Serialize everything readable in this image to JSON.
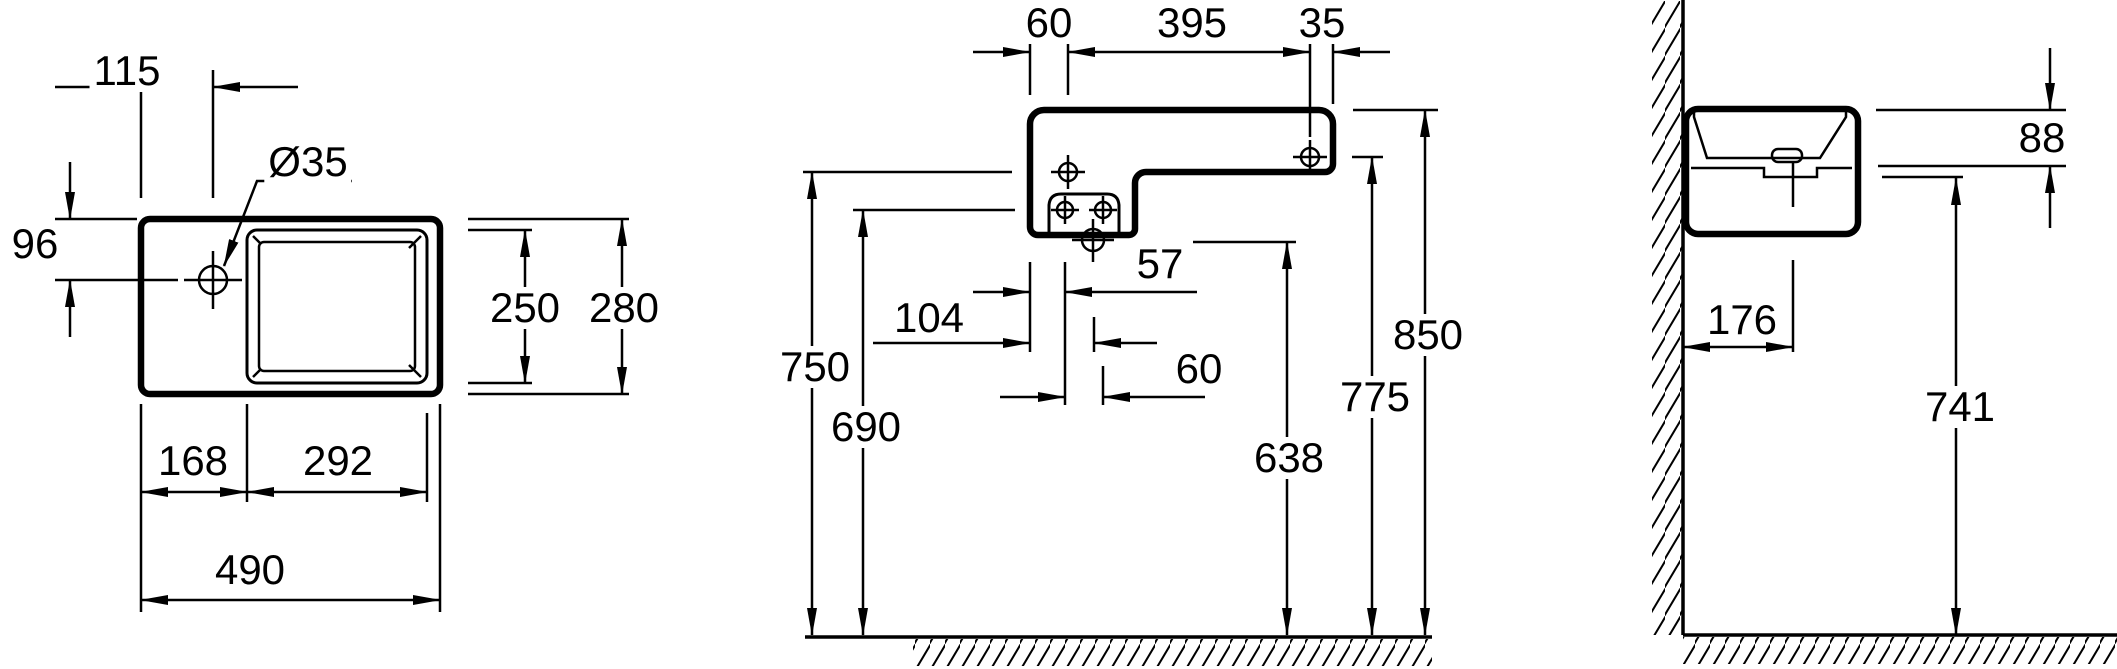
{
  "drawing": {
    "kind": "washbasin installation technical drawing, three orthographic views, dimensions in mm",
    "views": {
      "top_view": {
        "name": "top view",
        "dims": {
          "faucet_offset_from_left": "115",
          "faucet_hole_diameter": "Ø35",
          "faucet_offset_from_front": "96",
          "bowl_depth": "250",
          "overall_depth": "280",
          "ledge_width": "168",
          "bowl_width": "292",
          "overall_width": "490"
        }
      },
      "front_view": {
        "name": "front view",
        "dims": {
          "left_hole_offset": "60",
          "holes_spacing": "395",
          "right_hole_offset": "35",
          "bracket_left_hole_offset": "57",
          "drain_axis_offset": "104",
          "bracket_holes_spacing": "60",
          "floor_to_body_underside": "750",
          "floor_to_bracket_holes": "690",
          "floor_to_drain": "638",
          "floor_to_right_hole": "775",
          "floor_to_rim": "850"
        }
      },
      "side_view": {
        "name": "side view",
        "dims": {
          "rim_to_underside": "88",
          "wall_to_drain_axis": "176",
          "floor_to_underside": "741"
        }
      }
    }
  }
}
